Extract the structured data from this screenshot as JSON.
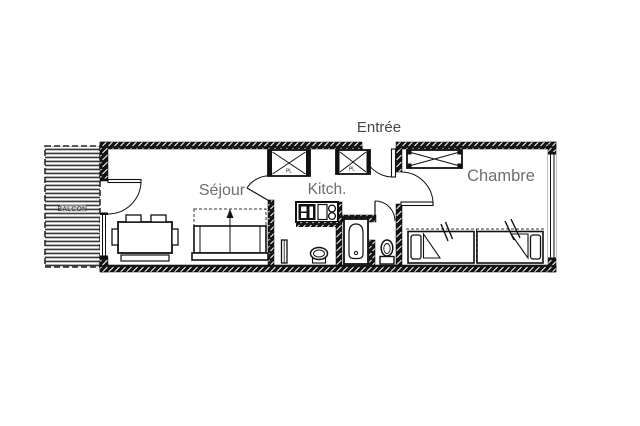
{
  "page": {
    "background": "#ffffff"
  },
  "plan": {
    "labels": {
      "entrance": "Entrée",
      "living_room": "Séjour",
      "kitchen": "Kitch.",
      "bedroom": "Chambre",
      "balcony": "BALCON",
      "closet_1": "PL",
      "closet_2": "PL"
    },
    "colors": {
      "wall": "#151515",
      "room_label": "#6e6e6e",
      "entrance_label": "#474747",
      "line": "#111111",
      "background": "#ffffff"
    },
    "furniture": [
      "dining-table",
      "chairs",
      "bench",
      "sofa-bed",
      "sofa-bed-open-dashed",
      "kitchen-counter",
      "stove",
      "sink-unit",
      "burners",
      "radiator",
      "washbasin",
      "bathtub",
      "toilet",
      "wardrobe",
      "closet-1",
      "closet-2",
      "single-bed-1",
      "single-bed-2"
    ]
  }
}
